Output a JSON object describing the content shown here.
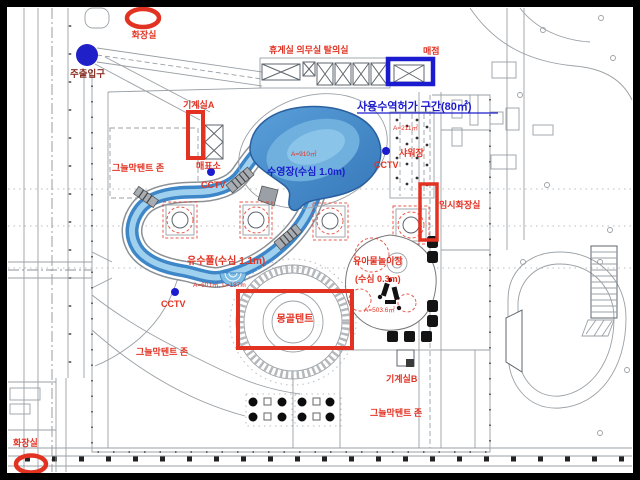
{
  "plan": {
    "labels": {
      "toilet": "화장실",
      "main_entrance": "주출입구",
      "machine_room_a": "기계실A",
      "machine_room_b": "기계실B",
      "shade_tent_zone": "그늘막텐트 존",
      "ticket_booth": "매표소",
      "cctv": "CCTV",
      "facility_row": "휴게실 의무실  탈의실",
      "snack_bar": "매점",
      "water_use_permit_zone": "사용수역허가 구간(80㎡)",
      "shower_area": "샤워장",
      "shower_area_size": "A=211㎡",
      "main_pool": "수영장(수심 1.0m)",
      "main_pool_size": "A=910㎡",
      "temporary_toilet": "임시화장실",
      "lazy_river": "유수풀(수심 1.1m)",
      "lazy_river_size": "A=601㎡, L=187m",
      "mongolian_tent": "몽골텐트",
      "kids_pool": "유아물놀이장",
      "kids_pool_depth": "(수심 0.3m)",
      "kids_pool_size": "A=503.6㎡"
    },
    "colors": {
      "annotation_red": "#e23222",
      "annotation_blue": "#1c1ccd",
      "entrance_marker_blue": "#2020c8",
      "water_dark": "#3d86c8",
      "water_light": "#9fd0ee"
    }
  }
}
